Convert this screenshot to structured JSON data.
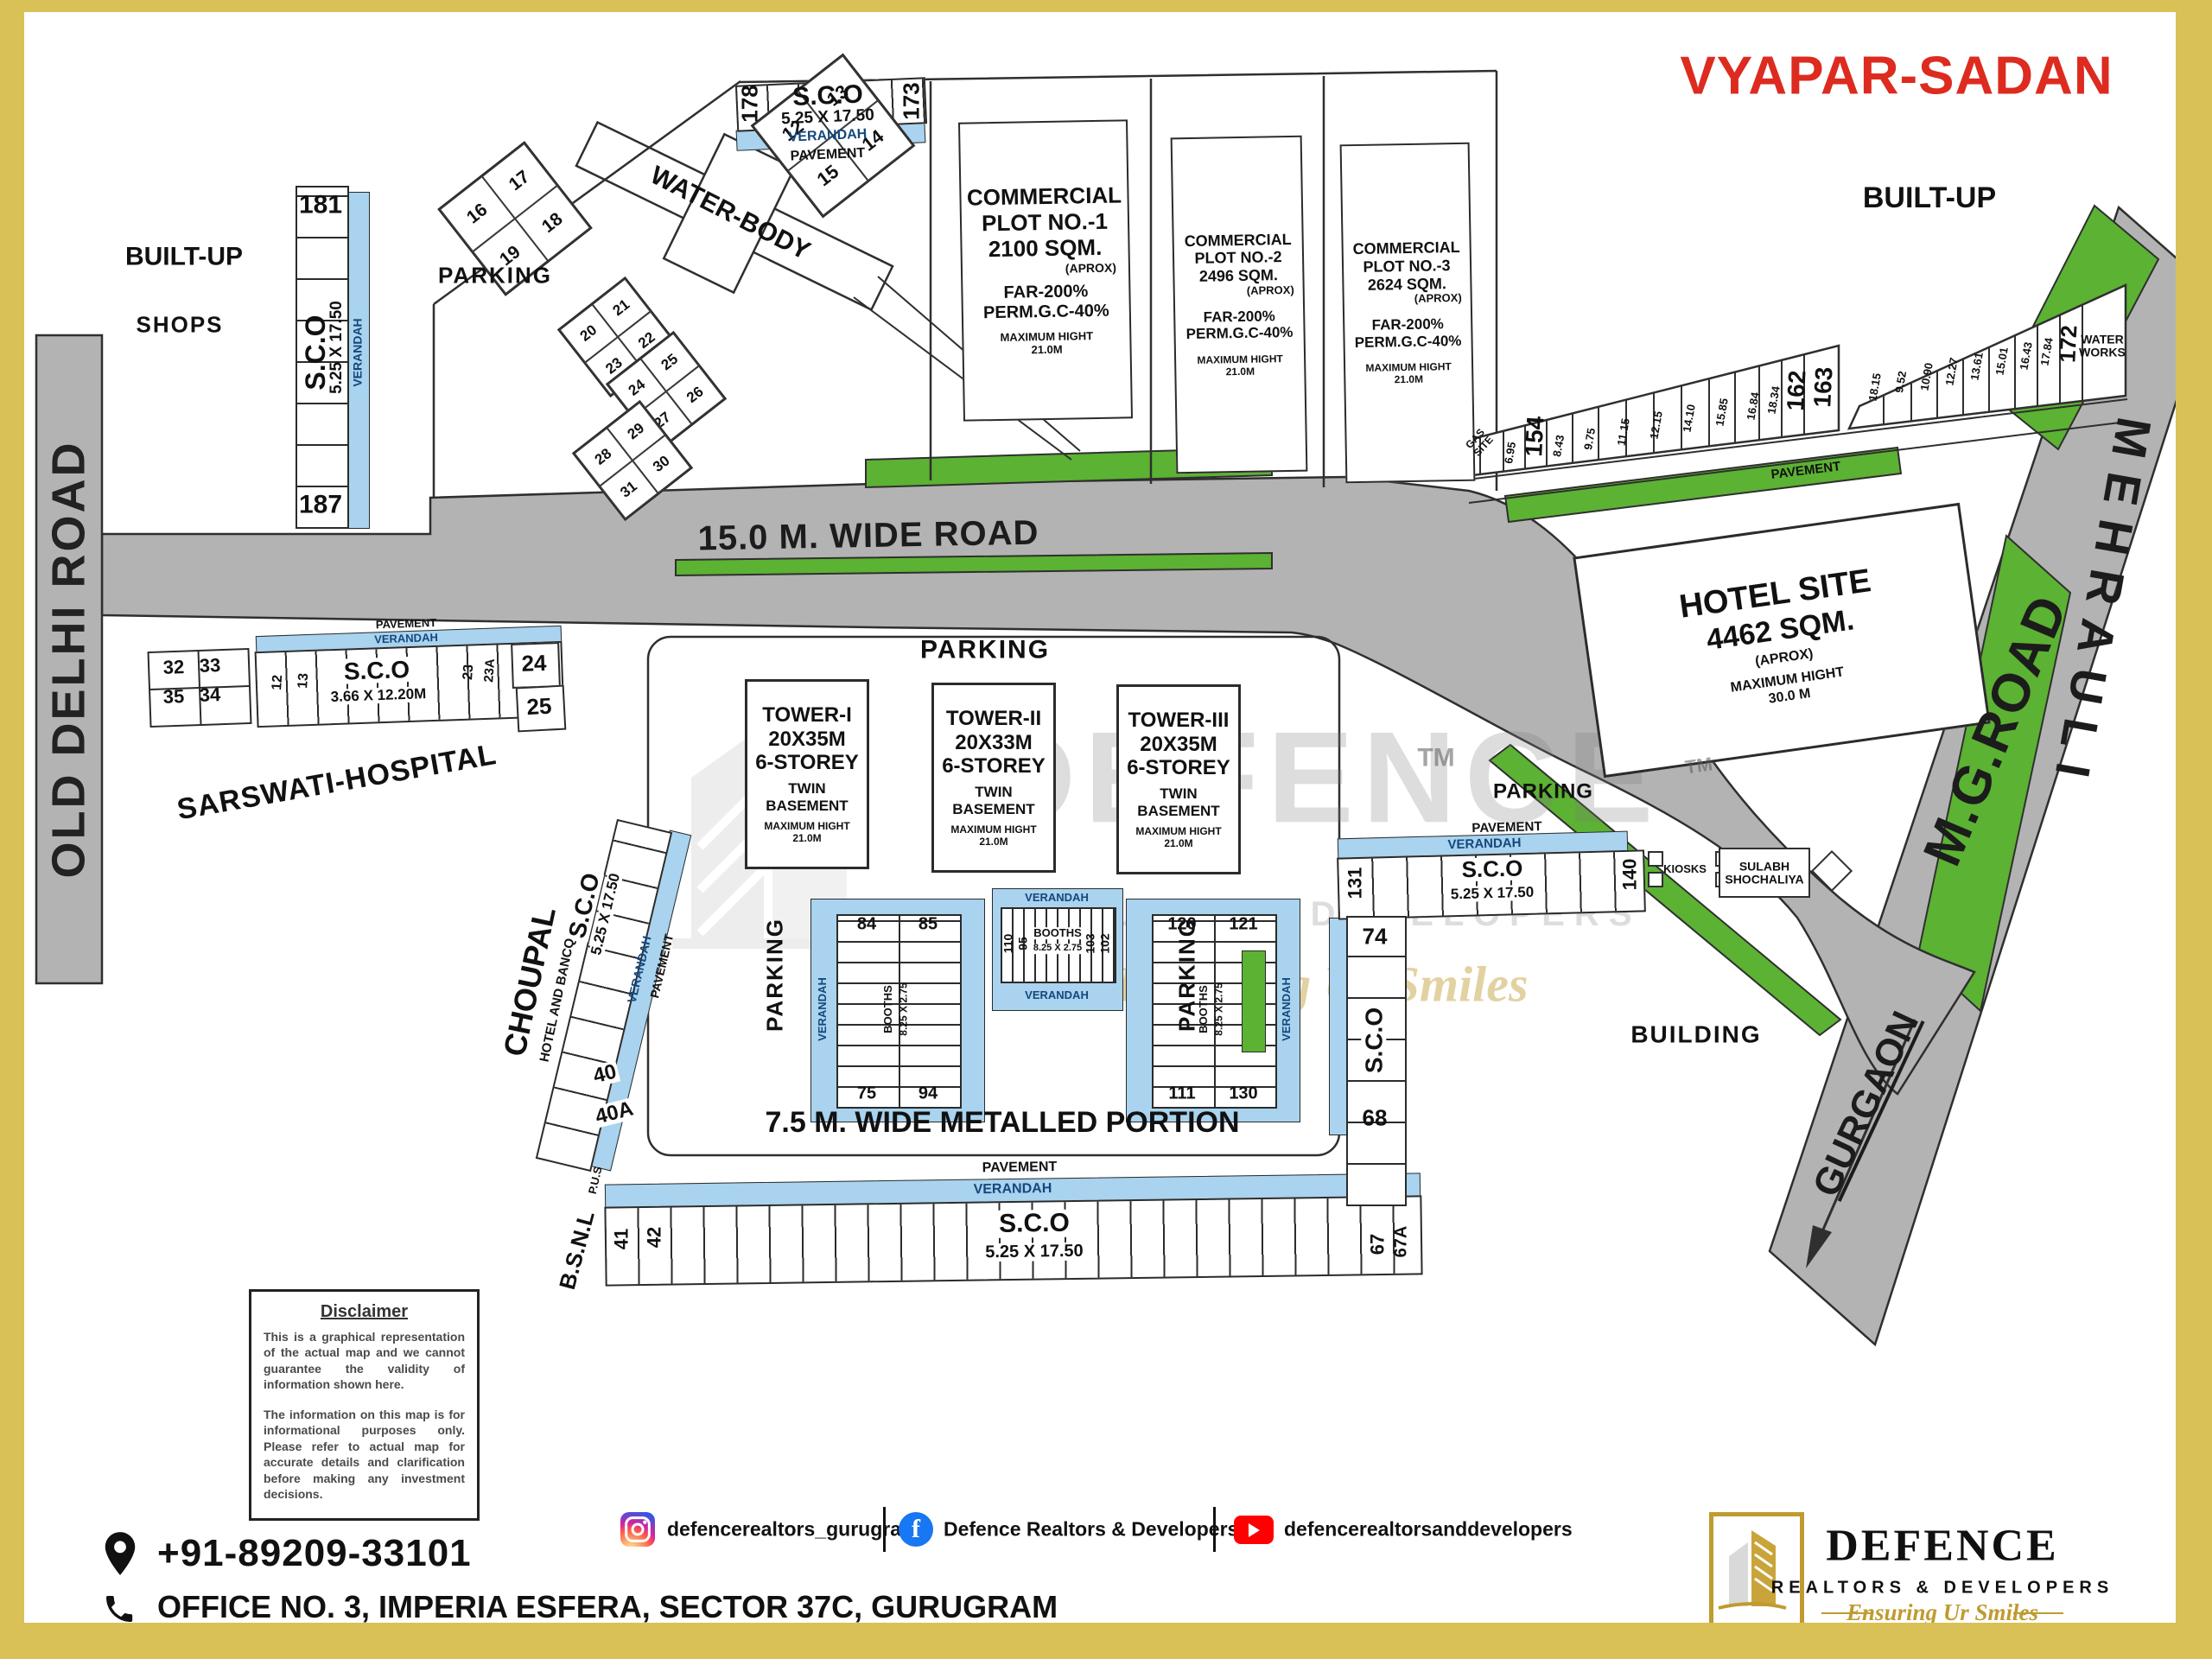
{
  "title": "VYAPAR-SADAN",
  "colors": {
    "frame": "#d9c157",
    "road": "#b3b3b3",
    "green": "#5cb233",
    "verandah": "#a9d3ee",
    "title_red": "#dd2b20",
    "gold": "#bf9b30"
  },
  "roads": {
    "old_delhi": "OLD DELHI ROAD",
    "wide_road": "15.0 M. WIDE ROAD",
    "metalled": "7.5 M. WIDE METALLED PORTION",
    "mg_road": "M.G.ROAD",
    "gurgaon": "GURGAON",
    "mehrauli": "MEHRAULI"
  },
  "areas": {
    "built_up_left": "BUILT-UP",
    "built_up_right": "BUILT-UP",
    "shops": "SHOPS",
    "parking_top": "PARKING",
    "parking_mid": "PARKING",
    "parking_left_v": "PARKING",
    "parking_right_v": "PARKING",
    "parking_hotel": "PARKING",
    "water_body": "WATER-BODY",
    "water_works": "WATER WORKS",
    "gas_site": "GAS SITE",
    "building": "BUILDING",
    "kiosks": "KIOSKS",
    "sulabh": "SULABH SHOCHALIYA",
    "hospital": "SARSWATI-HOSPITAL",
    "choupal": "CHOUPAL",
    "choupal_sub": "HOTEL AND BANCQUITES",
    "bsnl": "B.S.N.L",
    "pus": "P.U.S"
  },
  "labels": {
    "verandah": "VERANDAH",
    "pavement": "PAVEMENT",
    "sco": "S.C.O",
    "tm": "TM"
  },
  "sco": {
    "top": {
      "left": "178",
      "right": "173",
      "size": "5.25 X 17.50"
    },
    "strip181": {
      "top": "181",
      "bottom": "187",
      "size": "5.25 X 17.50"
    },
    "hospital_row": {
      "q1": "32",
      "q2": "33",
      "q3": "35",
      "q4": "34",
      "c1": "12",
      "c2": "13",
      "size": "3.66 X 12.20M",
      "c3": "23",
      "c4": "23A",
      "c5": "24",
      "c6": "25"
    },
    "choupal_strip": {
      "size": "5.25 X 17.50",
      "c1": "40",
      "c2": "40A"
    },
    "bottom_row": {
      "c1": "41",
      "c2": "42",
      "size": "5.25 X 17.50",
      "c3": "67",
      "c4": "67A"
    },
    "right_row": {
      "left": "131",
      "right": "140",
      "size": "5.25 X 17.50"
    },
    "right_col": {
      "top": "74",
      "bottom": "68"
    }
  },
  "plots": [
    {
      "l1": "COMMERCIAL",
      "l2": "PLOT NO.-1",
      "area": "2100 SQM.",
      "aprox": "(APROX)",
      "far": "FAR-200%",
      "gc": "PERM.G.C-40%",
      "mh": "MAXIMUM HIGHT",
      "h": "21.0M"
    },
    {
      "l1": "COMMERCIAL",
      "l2": "PLOT NO.-2",
      "area": "2496 SQM.",
      "aprox": "(APROX)",
      "far": "FAR-200%",
      "gc": "PERM.G.C-40%",
      "mh": "MAXIMUM HIGHT",
      "h": "21.0M"
    },
    {
      "l1": "COMMERCIAL",
      "l2": "PLOT NO.-3",
      "area": "2624 SQM.",
      "aprox": "(APROX)",
      "far": "FAR-200%",
      "gc": "PERM.G.C-40%",
      "mh": "MAXIMUM HIGHT",
      "h": "21.0M"
    }
  ],
  "towers": [
    {
      "name": "TOWER-I",
      "size": "20X35M",
      "storey": "6-STOREY",
      "t": "TWIN",
      "b": "BASEMENT",
      "mh": "MAXIMUM HIGHT",
      "h": "21.0M"
    },
    {
      "name": "TOWER-II",
      "size": "20X33M",
      "storey": "6-STOREY",
      "t": "TWIN",
      "b": "BASEMENT",
      "mh": "MAXIMUM HIGHT",
      "h": "21.0M"
    },
    {
      "name": "TOWER-III",
      "size": "20X35M",
      "storey": "6-STOREY",
      "t": "TWIN",
      "b": "BASEMENT",
      "mh": "MAXIMUM HIGHT",
      "h": "21.0M"
    }
  ],
  "hotel": {
    "l1": "HOTEL SITE",
    "l2": "4462 SQM.",
    "aprox": "(APROX)",
    "mh": "MAXIMUM HIGHT",
    "h": "30.0 M"
  },
  "diamonds": {
    "d1": [
      "12",
      "13",
      "15",
      "14"
    ],
    "d2": [
      "16",
      "17",
      "19",
      "18"
    ],
    "d3": [
      "20",
      "21",
      "23",
      "22"
    ],
    "d4": [
      "24",
      "25",
      "27",
      "26"
    ],
    "d5": [
      "28",
      "29",
      "31",
      "30"
    ]
  },
  "builtup_strip": {
    "cells_left": [
      "6.95",
      "154",
      "8.43",
      "9.75",
      "11.15",
      "12.15",
      "14.10",
      "15.85",
      "16.84",
      "18.34",
      "162",
      "163"
    ],
    "cells_right": [
      "18.15",
      "9.52",
      "10.90",
      "12.27",
      "13.61",
      "15.01",
      "16.43",
      "17.84",
      "172"
    ]
  },
  "booths": {
    "label": "BOOTHS",
    "size": "8.25 X 2.75",
    "left": {
      "tl": "84",
      "tr": "85",
      "bl": "75",
      "br": "94"
    },
    "mid": {
      "a": "110",
      "b": "95",
      "c": "103",
      "d": "102"
    },
    "right": {
      "tl": "120",
      "tr": "121",
      "bl": "111",
      "br": "130"
    }
  },
  "watermark": {
    "name": "DEFENCE",
    "sub": "R E A L T O R S   &   D E V E L O P E R S",
    "script": "Ensuring Ur Smiles"
  },
  "disclaimer": {
    "title": "Disclaimer",
    "p1": "This is a graphical representation of the actual map and we cannot guarantee the validity of information shown here.",
    "p2": "The information on this map is for informational purposes only. Please refer to actual map for accurate details and clarification before making any investment decisions."
  },
  "footer": {
    "phone": "+91-89209-33101",
    "address": "OFFICE NO. 3, IMPERIA ESFERA, SECTOR 37C, GURUGRAM",
    "instagram": "defencerealtors_gurugram",
    "facebook": "Defence Realtors & Developers",
    "youtube": "defencerealtorsanddevelopers",
    "logo": {
      "name": "DEFENCE",
      "sub": "REALTORS & DEVELOPERS",
      "tagline": "Ensuring Ur Smiles"
    }
  }
}
